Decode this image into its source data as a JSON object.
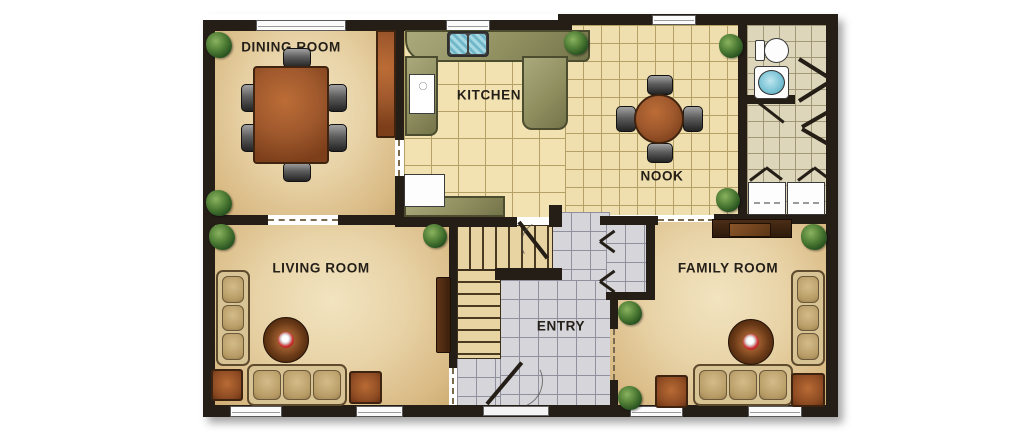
{
  "plan": {
    "title": "first floor plan",
    "rooms": {
      "dining": {
        "label": "DINING ROOM"
      },
      "kitchen": {
        "label": "KITCHEN"
      },
      "nook": {
        "label": "NOOK"
      },
      "living": {
        "label": "LIVING ROOM"
      },
      "entry": {
        "label": "ENTRY"
      },
      "family": {
        "label": "FAMILY ROOM"
      }
    },
    "colors": {
      "wall": "#241e17",
      "sand_floor": "#e8d3a7",
      "kitchen_tile": "#f2e2b2",
      "entry_tile": "#d5d5da",
      "bath_tile": "#ded6ba",
      "counter": "#8f8f60",
      "sink_water": "#7cc4d6",
      "wood": "#a0592d",
      "upholstery": "#d7c394",
      "plant": "#4c7a33",
      "flower_accent": "#cc3030"
    },
    "fixtures": [
      "dining-table",
      "dining-chairs",
      "hutch",
      "kitchen-counter",
      "double-sink",
      "stove",
      "refrigerator",
      "nook-table",
      "nook-chairs",
      "toilet",
      "bathroom-sink",
      "washer",
      "dryer",
      "staircase",
      "closet",
      "front-door",
      "sofa",
      "loveseat",
      "coffee-table",
      "end-table",
      "entertainment-center",
      "potted-plant",
      "window"
    ]
  }
}
